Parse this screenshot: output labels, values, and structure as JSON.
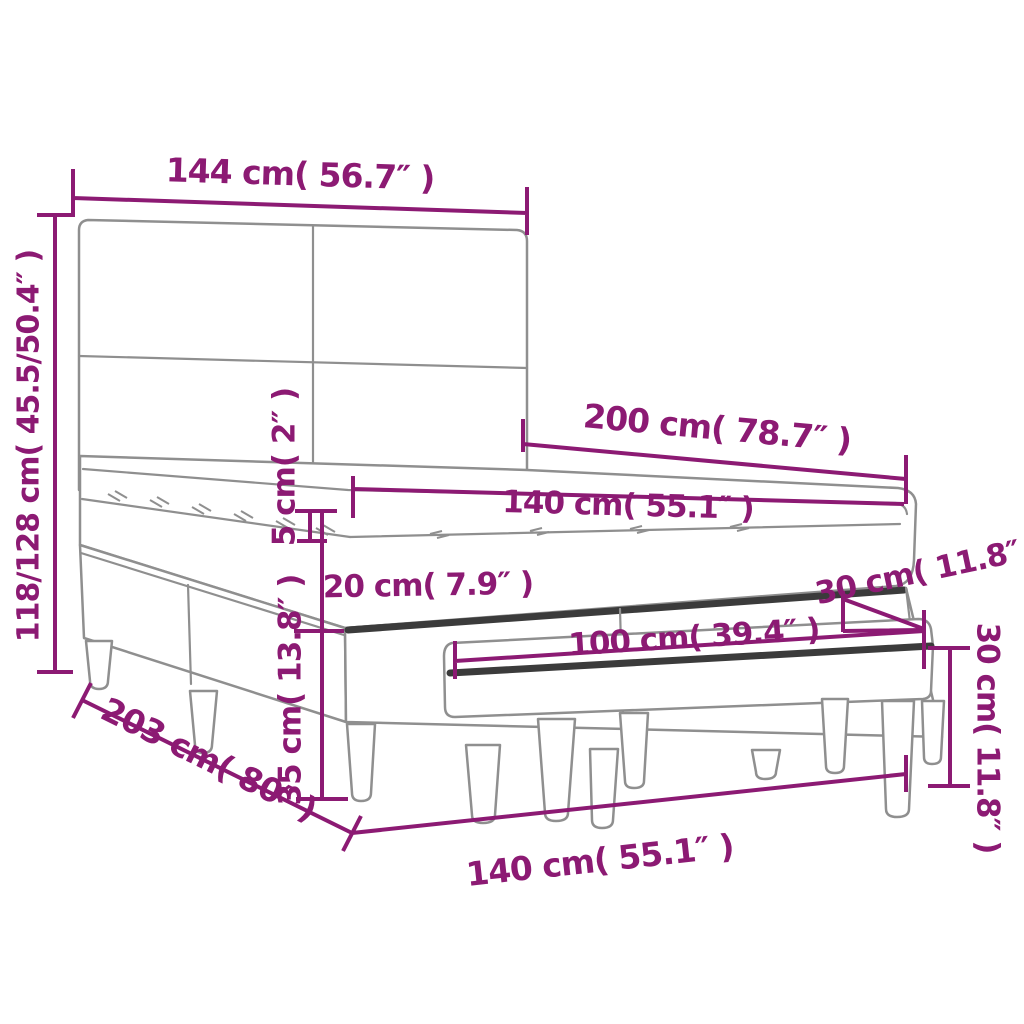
{
  "diagram": {
    "type": "product-dimension-diagram",
    "subject": "box spring bed with headboard, pillow-top mattress and bench",
    "colors": {
      "dimension_accent": "#8c1a73",
      "outline_gray": "#8f8f8f",
      "dark_edge": "#3b3b3b",
      "background": "#ffffff"
    },
    "measurements": {
      "headboard_width": "144 cm( 56.7″ )",
      "total_height": "118/128 cm( 45.5/50.4″ )",
      "bed_length": "200 cm( 78.7″ )",
      "mattress_width": "140 cm( 55.1″ )",
      "topper_thickness": "5 cm( 2″ )",
      "mattress_thickness": "20 cm( 7.9″ )",
      "base_corner_height": "30 cm( 11.8″ )",
      "bench_length": "100 cm( 39.4″ )",
      "bench_height": "30 cm( 11.8″ )",
      "base_height": "35 cm( 13.8″ )",
      "bed_total_length": "203 cm( 80″ )",
      "bed_width_bottom": "140 cm( 55.1″ )"
    }
  }
}
